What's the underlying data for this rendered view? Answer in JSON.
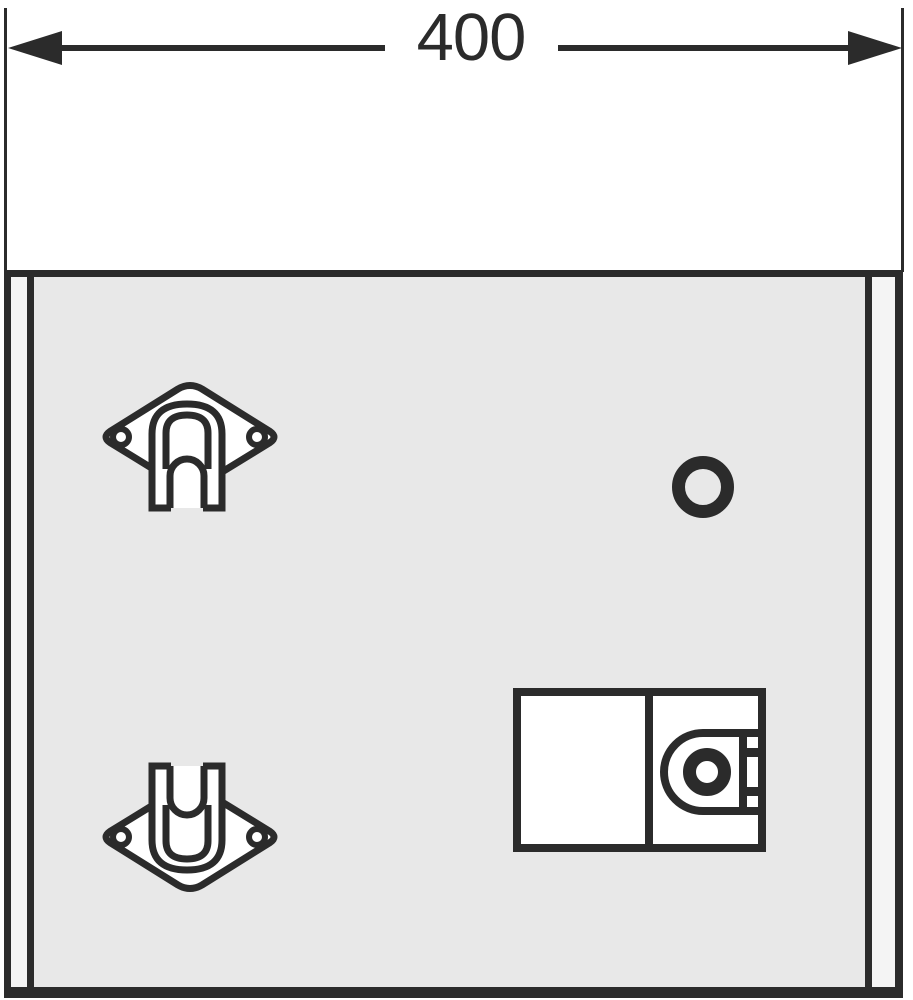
{
  "drawing": {
    "type": "furniture-assembly-dimension-drawing",
    "dimension": {
      "label": "400"
    },
    "colors": {
      "ink": "#2b2b2b",
      "panel_fill": "#e8e8e8",
      "edge_strip": "#f4f4f4",
      "part_fill": "#ffffff",
      "background": "#ffffff"
    },
    "icons": [
      "dimension-arrow-left-icon",
      "dimension-arrow-right-icon",
      "mounting-bracket-down-icon",
      "mounting-bracket-up-icon",
      "round-hole-icon",
      "lock-housing-icon"
    ]
  }
}
